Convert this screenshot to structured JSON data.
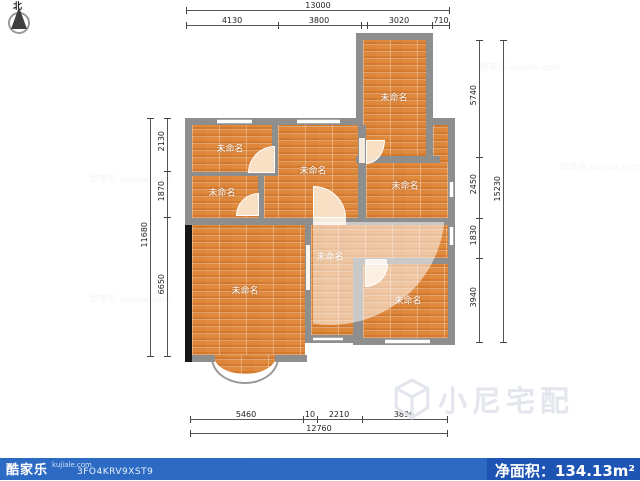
{
  "compass": {
    "north": "北"
  },
  "rooms": [
    {
      "name": "tower-room",
      "label": "未命名"
    },
    {
      "name": "top-left-room",
      "label": "未命名"
    },
    {
      "name": "left-middle-room",
      "label": "未命名"
    },
    {
      "name": "middle-room",
      "label": "未命名"
    },
    {
      "name": "right-middle-room",
      "label": "未命名"
    },
    {
      "name": "living-room",
      "label": "未命名"
    },
    {
      "name": "corridor",
      "label": "未命名"
    },
    {
      "name": "bottom-right-room",
      "label": "未命名"
    }
  ],
  "dims": {
    "top": {
      "total": "13000",
      "segments": [
        "4130",
        "3800",
        "3020",
        "710"
      ]
    },
    "left": {
      "total": "11680",
      "segments": [
        "2130",
        "1870",
        "6650"
      ]
    },
    "right": {
      "total": "15230",
      "segments": [
        "5740",
        "2450",
        "1830",
        "3940"
      ]
    },
    "bottom": {
      "total": "12760",
      "segments": [
        "5460",
        "10",
        "2210",
        "3890"
      ]
    }
  },
  "watermark": {
    "text": "小尼宅配",
    "logo": "cube-icon",
    "tile": "酷家乐 kujiale.com"
  },
  "footer": {
    "brand": "酷家乐",
    "site": "kujiale.com",
    "plan_code": "3FO4KRV9XST9",
    "area_text": "净面积：134.13m²"
  },
  "colors": {
    "floor": "#dd8436",
    "wall": "#8e8e8e",
    "wall_dark": "#161616",
    "footer_left": "#2d6ac3",
    "footer_right": "#1e55b4"
  }
}
